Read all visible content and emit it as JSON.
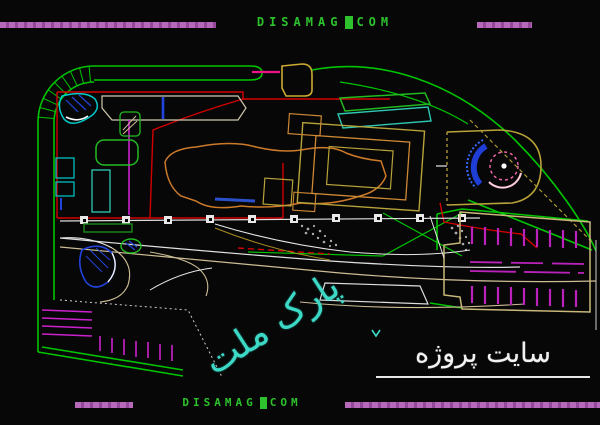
{
  "watermark_top": {
    "left": "DISAMAG",
    "right": "COM"
  },
  "watermark_bottom": {
    "left": "DISAMAG",
    "right": "COM"
  },
  "labels": {
    "park_name": "پارک ملت",
    "site_caption": "سایت پروژه"
  },
  "palette": {
    "background": "#070707",
    "boundary_green": "#00c400",
    "cad_red": "#d40000",
    "cad_magenta": "#cc22cc",
    "cad_cyan": "#00cccc",
    "cad_blue": "#2244dd",
    "cad_orange": "#cc7a2a",
    "cad_olive": "#b8a23a",
    "cad_tan": "#cdbd95",
    "cad_white": "#e8e8e8",
    "watermark_green": "#2dc22d",
    "watermark_bar_magenta": "#b565b5",
    "park_label_cyan": "#3cd9c6",
    "pink_accent": "#ee1188"
  }
}
